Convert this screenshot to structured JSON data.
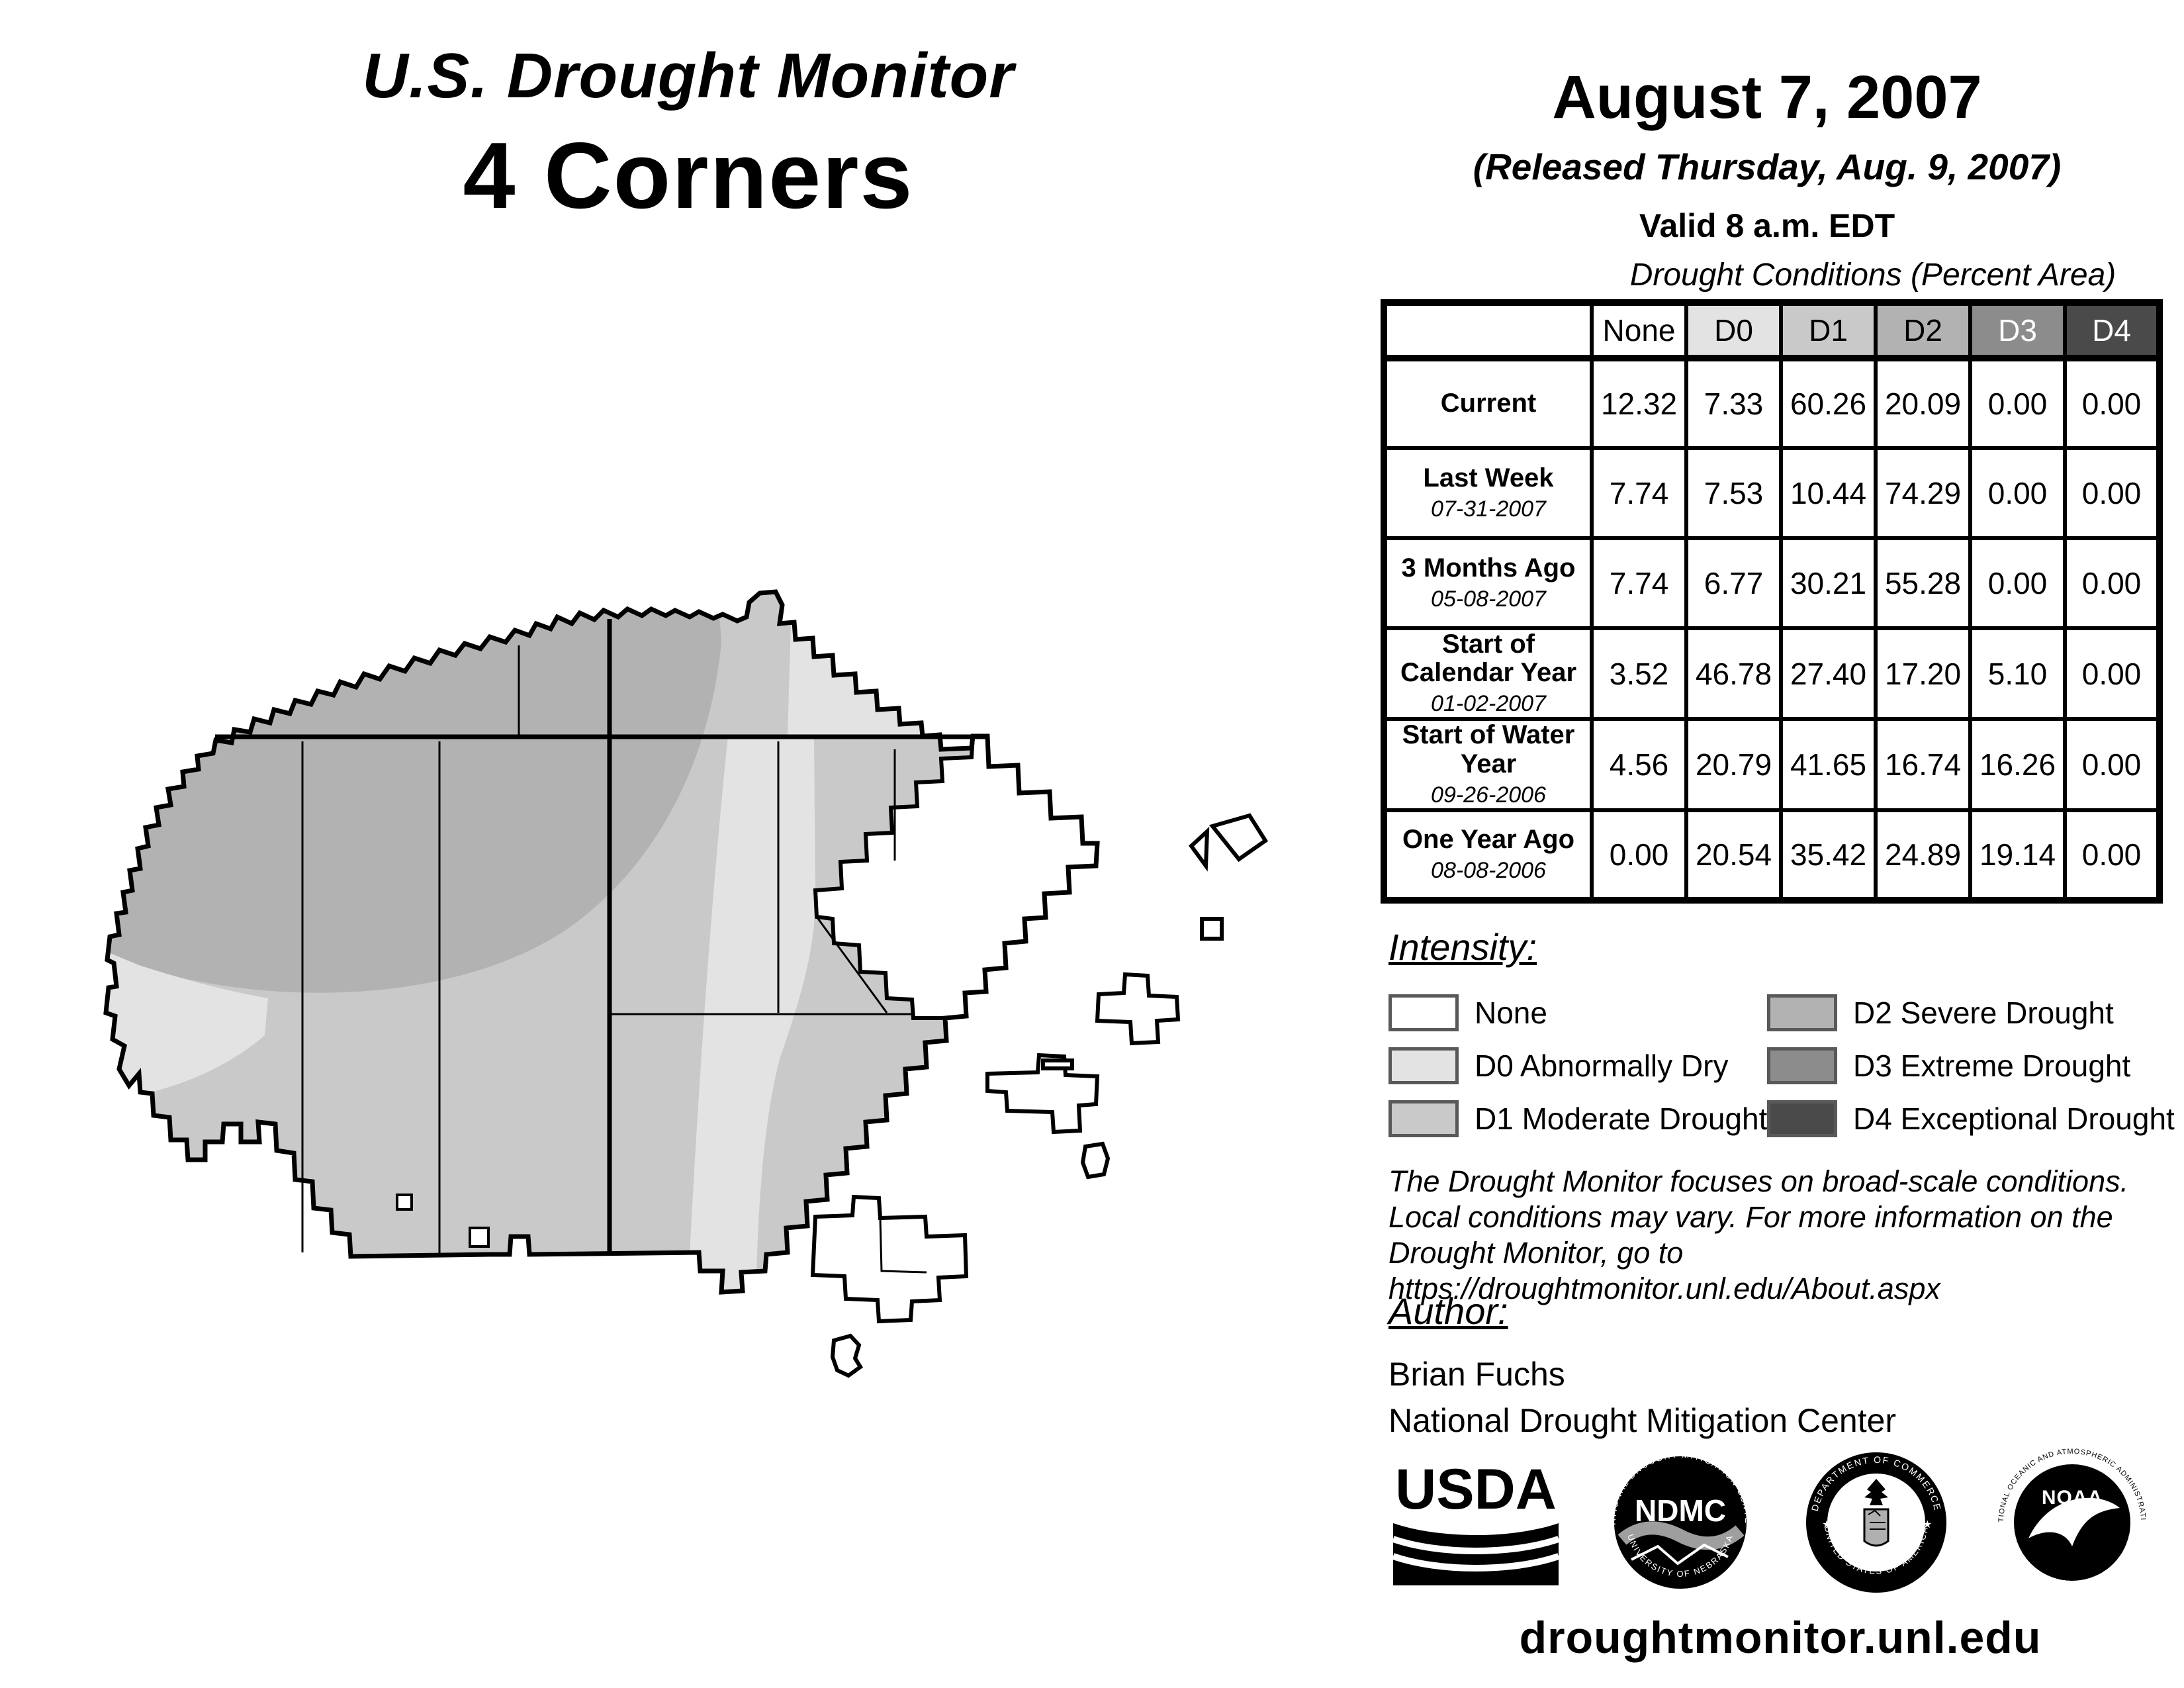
{
  "report": {
    "title": "U.S. Drought Monitor",
    "region": "4 Corners",
    "date": "August 7, 2007",
    "released": "(Released Thursday, Aug. 9, 2007)",
    "valid": "Valid 8 a.m. EDT"
  },
  "table": {
    "title": "Drought Conditions (Percent Area)",
    "columns": [
      "None",
      "D0",
      "D1",
      "D2",
      "D3",
      "D4"
    ],
    "rows": [
      {
        "label": "Current",
        "date": "",
        "values": [
          "12.32",
          "7.33",
          "60.26",
          "20.09",
          "0.00",
          "0.00"
        ]
      },
      {
        "label": "Last Week",
        "date": "07-31-2007",
        "values": [
          "7.74",
          "7.53",
          "10.44",
          "74.29",
          "0.00",
          "0.00"
        ]
      },
      {
        "label": "3 Months Ago",
        "date": "05-08-2007",
        "values": [
          "7.74",
          "6.77",
          "30.21",
          "55.28",
          "0.00",
          "0.00"
        ]
      },
      {
        "label": "Start of Calendar Year",
        "date": "01-02-2007",
        "values": [
          "3.52",
          "46.78",
          "27.40",
          "17.20",
          "5.10",
          "0.00"
        ]
      },
      {
        "label": "Start of Water Year",
        "date": "09-26-2006",
        "values": [
          "4.56",
          "20.79",
          "41.65",
          "16.74",
          "16.26",
          "0.00"
        ]
      },
      {
        "label": "One Year Ago",
        "date": "08-08-2006",
        "values": [
          "0.00",
          "20.54",
          "35.42",
          "24.89",
          "19.14",
          "0.00"
        ]
      }
    ]
  },
  "legend": {
    "heading": "Intensity:",
    "items": [
      {
        "label": "None",
        "color": "#ffffff"
      },
      {
        "label": "D0 Abnormally Dry",
        "color": "#e3e3e3"
      },
      {
        "label": "D1 Moderate Drought",
        "color": "#c9c9c9"
      },
      {
        "label": "D2 Severe Drought",
        "color": "#b2b2b2"
      },
      {
        "label": "D3 Extreme Drought",
        "color": "#8c8c8c"
      },
      {
        "label": "D4 Exceptional Drought",
        "color": "#4a4a4a"
      }
    ]
  },
  "colors": {
    "none": "#ffffff",
    "d0": "#e3e3e3",
    "d1": "#c9c9c9",
    "d2": "#b2b2b2",
    "d3": "#8c8c8c",
    "d4": "#4a4a4a",
    "outline": "#000000",
    "ndmc_wave": "#9e9e9e",
    "doc_shield": "#b0b0b0"
  },
  "disclaimer": {
    "line1": "The Drought Monitor focuses on broad-scale conditions.",
    "line2": "Local conditions may vary. For more information on the",
    "line3": "Drought Monitor, go to https://droughtmonitor.unl.edu/About.aspx"
  },
  "author": {
    "heading": "Author:",
    "name": "Brian Fuchs",
    "org": "National Drought Mitigation Center"
  },
  "logos": {
    "usda": {
      "text": "USDA"
    },
    "ndmc": {
      "center": "NDMC",
      "top": "NATIONAL DROUGHT MITIGATION CENTER",
      "bottom": "UNIVERSITY OF NEBRASKA"
    },
    "commerce": {
      "top": "DEPARTMENT OF COMMERCE",
      "bottom": "UNITED STATES OF AMERICA"
    },
    "noaa": {
      "center": "NOAA",
      "top": "NATIONAL OCEANIC AND ATMOSPHERIC ADMINISTRATION",
      "bottom": "U.S. DEPARTMENT OF COMMERCE"
    }
  },
  "footer": {
    "url": "droughtmonitor.unl.edu"
  }
}
